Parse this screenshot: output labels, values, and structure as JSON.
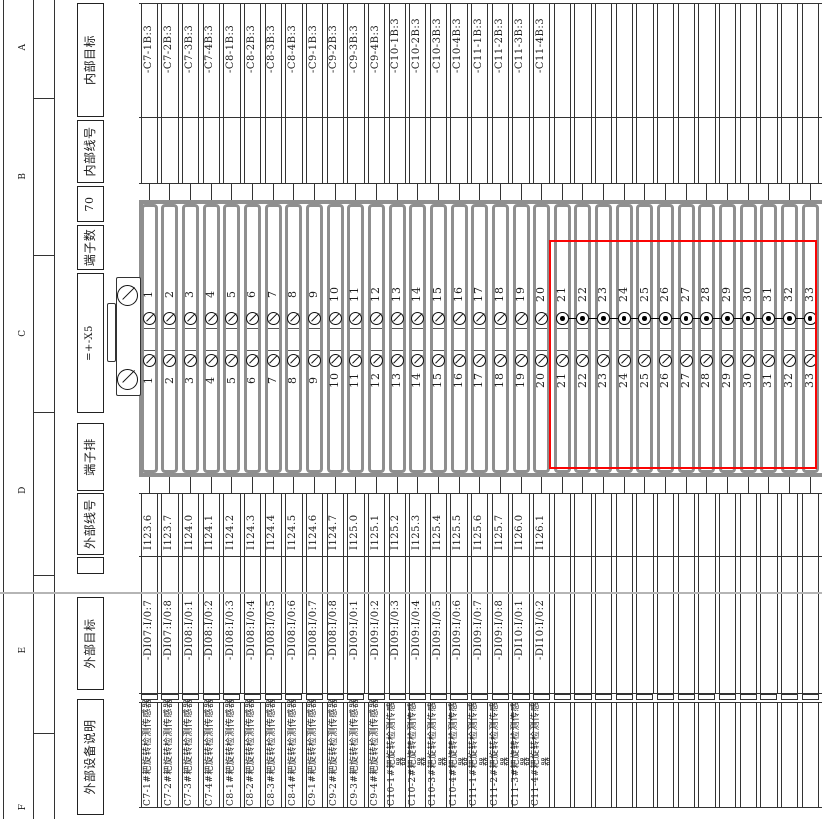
{
  "sheet_type": "terminal-strip-wiring-diagram",
  "zones": {
    "letters": [
      "A",
      "B",
      "C",
      "D",
      "E",
      "F"
    ]
  },
  "headers": {
    "internal_target": "内部目标",
    "internal_wire_no": "内部线号",
    "terminal_count_value": "70",
    "terminal_count_label": "端子数",
    "strip_designation": "=+-X5",
    "terminal_strip_label": "端子排",
    "external_wire_no": "外部线号",
    "spacer": "",
    "external_target": "外部目标",
    "external_device_desc": "外部设备说明"
  },
  "strip": {
    "designation": "=+-X5",
    "terminal_count": "70",
    "visible_terminal_range": "1-33",
    "jumpered_terminal_range": "21-33",
    "highlight_terminal_range": "21-33",
    "highlight_color": "#fb0404"
  },
  "columns": [
    {
      "num": "1",
      "internal_target": "-C7-1B:3",
      "external_wire": "I123.6",
      "external_target": "-DI07:I/0:7",
      "device": "C7-1#耙旋转检测传感器",
      "jumpered": false
    },
    {
      "num": "2",
      "internal_target": "-C7-2B:3",
      "external_wire": "I123.7",
      "external_target": "-DI07:I/0:8",
      "device": "C7-2#耙旋转检测传感器",
      "jumpered": false
    },
    {
      "num": "3",
      "internal_target": "-C7-3B:3",
      "external_wire": "I124.0",
      "external_target": "-DI08:I/0:1",
      "device": "C7-3#耙旋转检测传感器",
      "jumpered": false
    },
    {
      "num": "4",
      "internal_target": "-C7-4B:3",
      "external_wire": "I124.1",
      "external_target": "-DI08:I/0:2",
      "device": "C7-4#耙旋转检测传感器",
      "jumpered": false
    },
    {
      "num": "5",
      "internal_target": "-C8-1B:3",
      "external_wire": "I124.2",
      "external_target": "-DI08:I/0:3",
      "device": "C8-1#耙旋转检测传感器",
      "jumpered": false
    },
    {
      "num": "6",
      "internal_target": "-C8-2B:3",
      "external_wire": "I124.3",
      "external_target": "-DI08:I/0:4",
      "device": "C8-2#耙旋转检测传感器",
      "jumpered": false
    },
    {
      "num": "7",
      "internal_target": "-C8-3B:3",
      "external_wire": "I124.4",
      "external_target": "-DI08:I/0:5",
      "device": "C8-3#耙旋转检测传感器",
      "jumpered": false
    },
    {
      "num": "8",
      "internal_target": "-C8-4B:3",
      "external_wire": "I124.5",
      "external_target": "-DI08:I/0:6",
      "device": "C8-4#耙旋转检测传感器",
      "jumpered": false
    },
    {
      "num": "9",
      "internal_target": "-C9-1B:3",
      "external_wire": "I124.6",
      "external_target": "-DI08:I/0:7",
      "device": "C9-1#耙旋转检测传感器",
      "jumpered": false
    },
    {
      "num": "10",
      "internal_target": "-C9-2B:3",
      "external_wire": "I124.7",
      "external_target": "-DI08:I/0:8",
      "device": "C9-2#耙旋转检测传感器",
      "jumpered": false
    },
    {
      "num": "11",
      "internal_target": "-C9-3B:3",
      "external_wire": "I125.0",
      "external_target": "-DI09:I/0:1",
      "device": "C9-3#耙旋转检测传感器",
      "jumpered": false
    },
    {
      "num": "12",
      "internal_target": "-C9-4B:3",
      "external_wire": "I125.1",
      "external_target": "-DI09:I/0:2",
      "device": "C9-4#耙旋转检测传感器",
      "jumpered": false
    },
    {
      "num": "13",
      "internal_target": "-C10-1B:3",
      "external_wire": "I125.2",
      "external_target": "-DI09:I/0:3",
      "device": "C10-1#耙旋转检测传感器",
      "jumpered": false
    },
    {
      "num": "14",
      "internal_target": "-C10-2B:3",
      "external_wire": "I125.3",
      "external_target": "-DI09:I/0:4",
      "device": "C10-2#耙旋转检测传感器",
      "jumpered": false
    },
    {
      "num": "15",
      "internal_target": "-C10-3B:3",
      "external_wire": "I125.4",
      "external_target": "-DI09:I/0:5",
      "device": "C10-3#耙旋转检测传感器",
      "jumpered": false
    },
    {
      "num": "16",
      "internal_target": "-C10-4B:3",
      "external_wire": "I125.5",
      "external_target": "-DI09:I/0:6",
      "device": "C10-4#耙旋转检测传感器",
      "jumpered": false
    },
    {
      "num": "17",
      "internal_target": "-C11-1B:3",
      "external_wire": "I125.6",
      "external_target": "-DI09:I/0:7",
      "device": "C11-1#耙旋转检测传感器",
      "jumpered": false
    },
    {
      "num": "18",
      "internal_target": "-C11-2B:3",
      "external_wire": "I125.7",
      "external_target": "-DI09:I/0:8",
      "device": "C11-2#耙旋转检测传感器",
      "jumpered": false
    },
    {
      "num": "19",
      "internal_target": "-C11-3B:3",
      "external_wire": "I126.0",
      "external_target": "-DI10:I/0:1",
      "device": "C11-3#耙旋转检测传感器",
      "jumpered": false
    },
    {
      "num": "20",
      "internal_target": "-C11-4B:3",
      "external_wire": "I126.1",
      "external_target": "-DI10:I/0:2",
      "device": "C11-4#耙旋转检测传感器",
      "jumpered": false
    },
    {
      "num": "21",
      "jumpered": true
    },
    {
      "num": "22",
      "jumpered": true
    },
    {
      "num": "23",
      "jumpered": true
    },
    {
      "num": "24",
      "jumpered": true
    },
    {
      "num": "25",
      "jumpered": true
    },
    {
      "num": "26",
      "jumpered": true
    },
    {
      "num": "27",
      "jumpered": true
    },
    {
      "num": "28",
      "jumpered": true
    },
    {
      "num": "29",
      "jumpered": true
    },
    {
      "num": "30",
      "jumpered": true
    },
    {
      "num": "31",
      "jumpered": true
    },
    {
      "num": "32",
      "jumpered": true
    },
    {
      "num": "33",
      "jumpered": true
    }
  ]
}
